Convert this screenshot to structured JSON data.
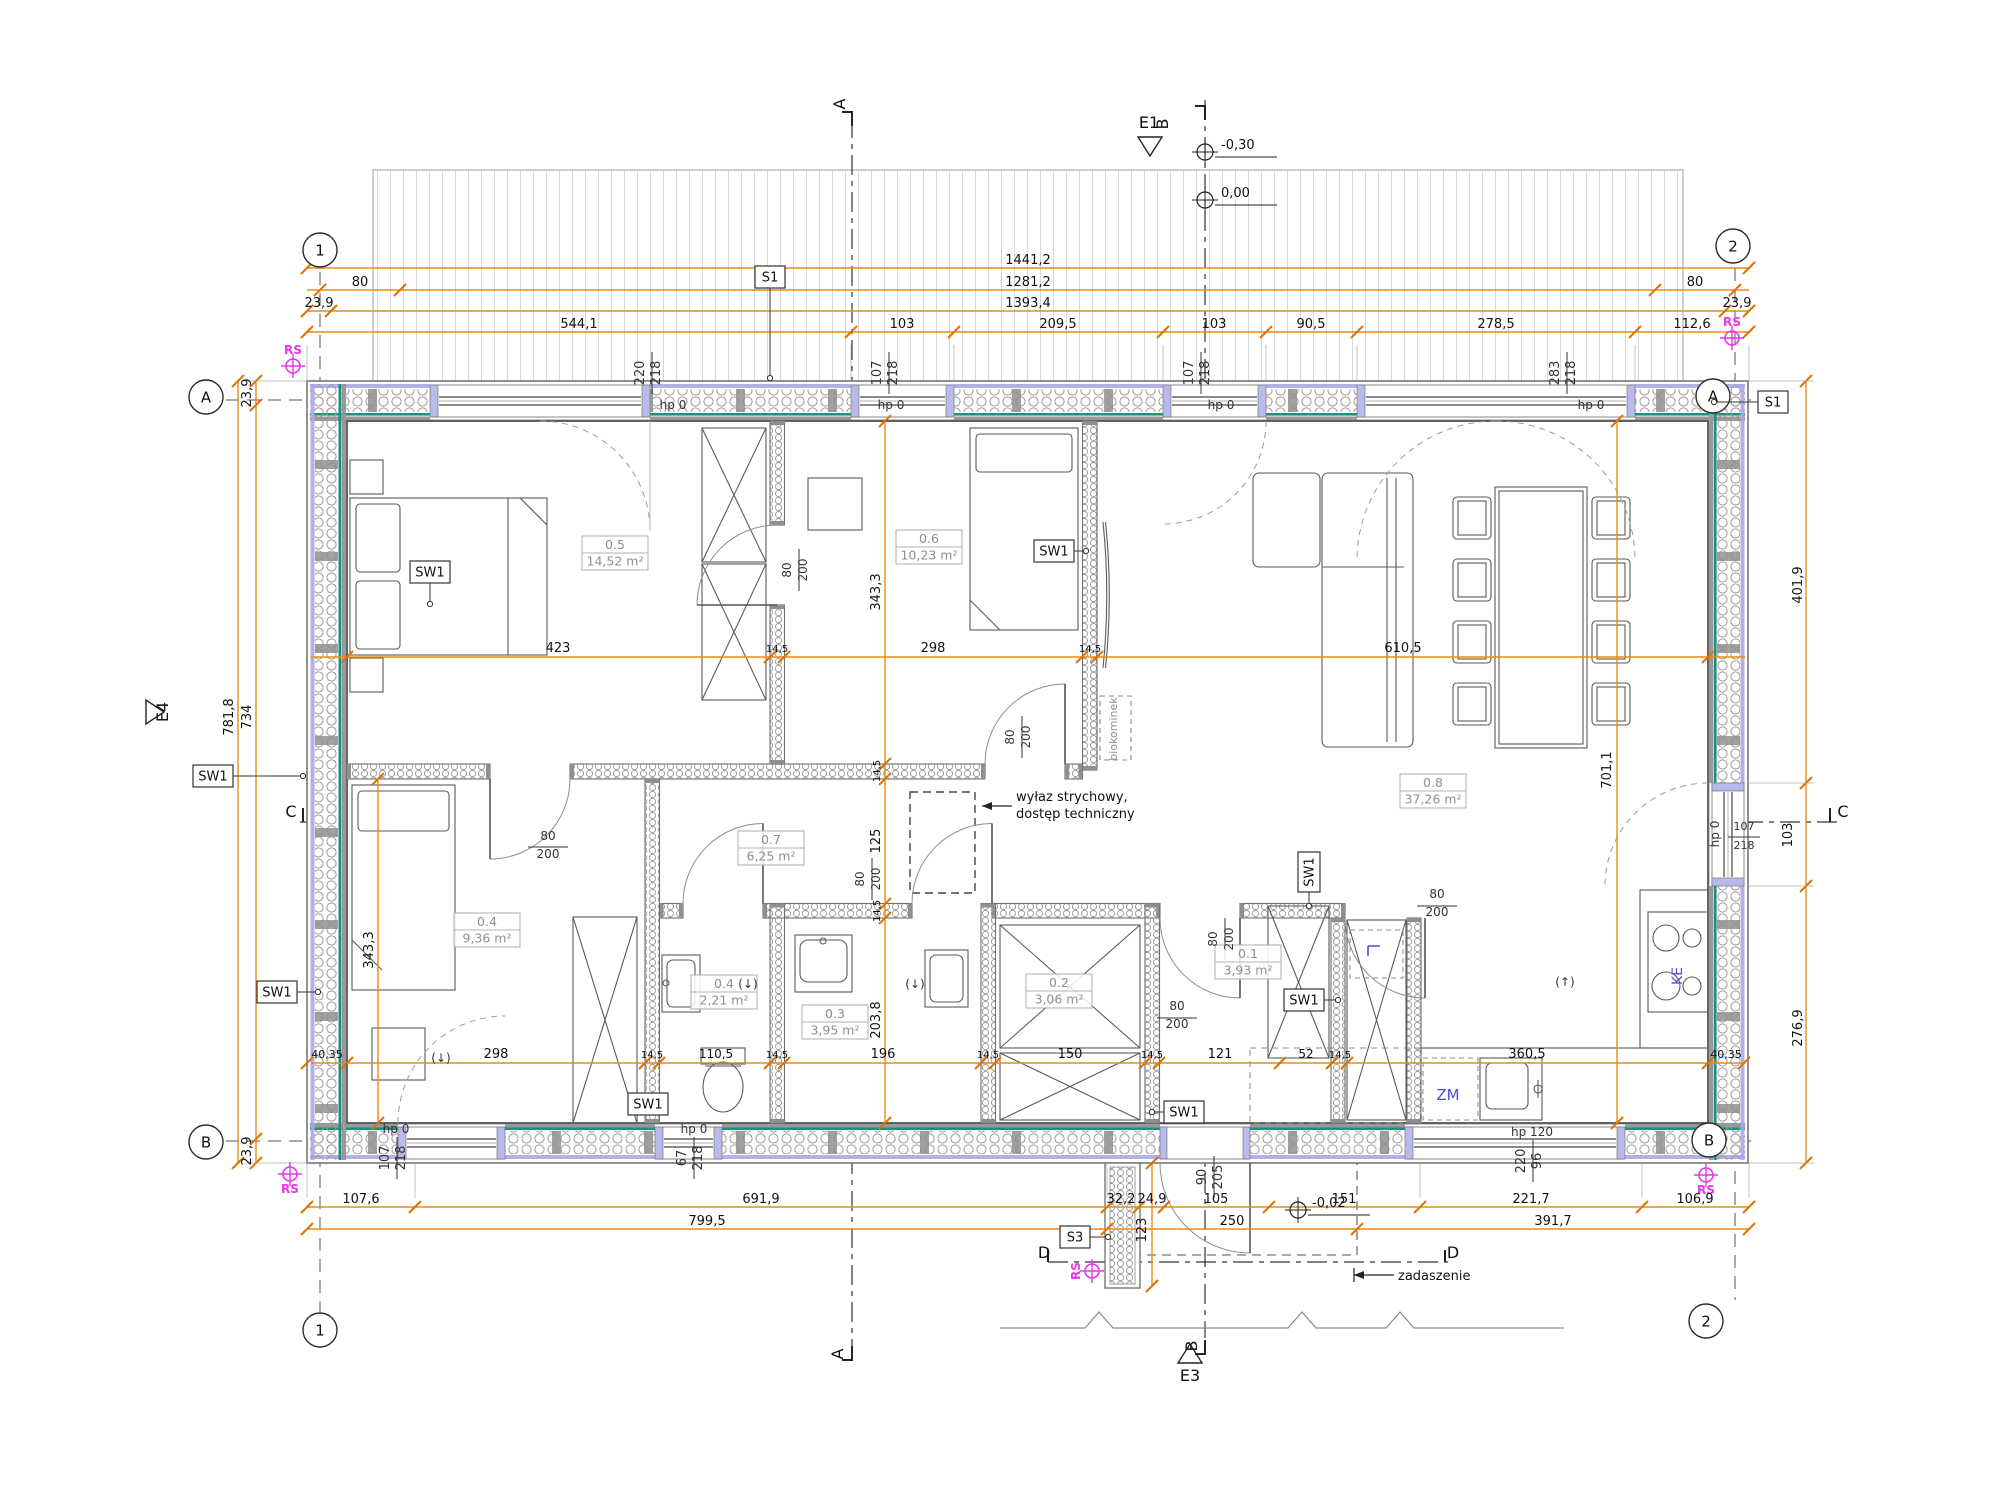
{
  "colors": {
    "dimension_orange": "#ee8a15",
    "tick_orange": "#dd7300",
    "survey_magenta": "#e836e8",
    "equipment_blue": "#4f4fd8",
    "wall_teal": "#1d8f7f",
    "wall_lilac": "#a9a9e6",
    "room_label_gray": "#8f8f8f",
    "line_dark": "#1a1a1a"
  },
  "grid_axes": [
    {
      "t": "1",
      "x": 320,
      "y": 250
    },
    {
      "t": "2",
      "x": 1733,
      "y": 246
    },
    {
      "t": "1",
      "x": 320,
      "y": 1330
    },
    {
      "t": "2",
      "x": 1706,
      "y": 1321
    },
    {
      "t": "A",
      "x": 206,
      "y": 397
    },
    {
      "t": "A",
      "x": 1713,
      "y": 396
    },
    {
      "t": "B",
      "x": 206,
      "y": 1142
    },
    {
      "t": "B",
      "x": 1709,
      "y": 1140
    }
  ],
  "sections": [
    {
      "t": "A",
      "x": 845,
      "y": 104,
      "r": -90
    },
    {
      "t": "A",
      "x": 843,
      "y": 1354,
      "r": -90
    },
    {
      "t": "B",
      "x": 1168,
      "y": 124,
      "r": -90
    },
    {
      "t": "B",
      "x": 1197,
      "y": 1346,
      "r": -90
    },
    {
      "t": "C",
      "x": 291,
      "y": 817
    },
    {
      "t": "C",
      "x": 1843,
      "y": 817
    },
    {
      "t": "D",
      "x": 1044,
      "y": 1258
    },
    {
      "t": "D",
      "x": 1453,
      "y": 1258
    },
    {
      "t": "E1",
      "x": 1149,
      "y": 128
    },
    {
      "t": "E3",
      "x": 1190,
      "y": 1381
    },
    {
      "t": "E4",
      "x": 168,
      "y": 712,
      "r": -90
    }
  ],
  "levels": [
    {
      "t": "-0,30",
      "x": 1205,
      "y": 152,
      "tx": 1221,
      "ty": 149
    },
    {
      "t": "0,00",
      "x": 1205,
      "y": 200,
      "tx": 1221,
      "ty": 197
    },
    {
      "t": "-0,02",
      "x": 1298,
      "y": 1210,
      "tx": 1312,
      "ty": 1207
    }
  ],
  "survey_points": [
    {
      "t": "RS",
      "x": 293,
      "y": 366,
      "tx": 293,
      "ty": 354
    },
    {
      "t": "RS",
      "x": 1732,
      "y": 338,
      "tx": 1732,
      "ty": 326
    },
    {
      "t": "RS",
      "x": 290,
      "y": 1174,
      "tx": 290,
      "ty": 1193
    },
    {
      "t": "RS",
      "x": 1706,
      "y": 1175,
      "tx": 1706,
      "ty": 1194
    },
    {
      "t": "RS",
      "x": 1092,
      "y": 1271,
      "tx": 1080,
      "ty": 1271,
      "r": -90
    }
  ],
  "rooms": [
    {
      "id": "0.5",
      "area": "14,52 m²",
      "x": 615,
      "y": 553
    },
    {
      "id": "0.6",
      "area": "10,23 m²",
      "x": 929,
      "y": 547
    },
    {
      "id": "0.8",
      "area": "37,26 m²",
      "x": 1433,
      "y": 791
    },
    {
      "id": "0.7",
      "area": "6,25 m²",
      "x": 771,
      "y": 848
    },
    {
      "id": "0.4",
      "area": "9,36 m²",
      "x": 487,
      "y": 930
    },
    {
      "id": "0.4",
      "area": "2,21 m²",
      "x": 724,
      "y": 992
    },
    {
      "id": "0.3",
      "area": "3,95 m²",
      "x": 835,
      "y": 1022
    },
    {
      "id": "0.2",
      "area": "3,06 m²",
      "x": 1059,
      "y": 991
    },
    {
      "id": "0.1",
      "area": "3,93 m²",
      "x": 1248,
      "y": 962
    }
  ],
  "component_tags": [
    {
      "t": "SW1",
      "x": 213,
      "y": 776,
      "lx": 303,
      "ly": 776
    },
    {
      "t": "SW1",
      "x": 277,
      "y": 992,
      "lx": 318,
      "ly": 992
    },
    {
      "t": "SW1",
      "x": 430,
      "y": 572,
      "lx": 430,
      "ly": 604
    },
    {
      "t": "SW1",
      "x": 1054,
      "y": 551,
      "lx": 1086,
      "ly": 551
    },
    {
      "t": "SW1",
      "x": 648,
      "y": 1104,
      "lx": 634,
      "ly": 1104
    },
    {
      "t": "SW1",
      "x": 1184,
      "y": 1112,
      "lx": 1152,
      "ly": 1112
    },
    {
      "t": "SW1",
      "x": 1309,
      "y": 872,
      "lx": 1309,
      "ly": 906,
      "r": -90
    },
    {
      "t": "SW1",
      "x": 1304,
      "y": 1000,
      "lx": 1338,
      "ly": 1000
    },
    {
      "t": "S1",
      "x": 770,
      "y": 277,
      "lx": 770,
      "ly": 378
    },
    {
      "t": "S1",
      "x": 1773,
      "y": 402,
      "lx": 1714,
      "ly": 402
    },
    {
      "t": "S3",
      "x": 1075,
      "y": 1237,
      "lx": 1108,
      "ly": 1237
    }
  ],
  "dimensions": [
    {
      "t": "1441,2",
      "x": 1028,
      "y": 264
    },
    {
      "t": "80",
      "x": 360,
      "y": 286
    },
    {
      "t": "1281,2",
      "x": 1028,
      "y": 286
    },
    {
      "t": "80",
      "x": 1695,
      "y": 286
    },
    {
      "t": "23,9",
      "x": 319,
      "y": 307
    },
    {
      "t": "1393,4",
      "x": 1028,
      "y": 307
    },
    {
      "t": "23,9",
      "x": 1737,
      "y": 307
    },
    {
      "t": "544,1",
      "x": 579,
      "y": 328
    },
    {
      "t": "103",
      "x": 902,
      "y": 328
    },
    {
      "t": "209,5",
      "x": 1058,
      "y": 328
    },
    {
      "t": "103",
      "x": 1214,
      "y": 328
    },
    {
      "t": "90,5",
      "x": 1311,
      "y": 328
    },
    {
      "t": "278,5",
      "x": 1496,
      "y": 328
    },
    {
      "t": "112,6",
      "x": 1692,
      "y": 328
    },
    {
      "t": "107,6",
      "x": 361,
      "y": 1203
    },
    {
      "t": "691,9",
      "x": 761,
      "y": 1203
    },
    {
      "t": "32,2",
      "x": 1121,
      "y": 1203
    },
    {
      "t": "24,9",
      "x": 1152,
      "y": 1203
    },
    {
      "t": "105",
      "x": 1216,
      "y": 1203
    },
    {
      "t": "151",
      "x": 1344,
      "y": 1203
    },
    {
      "t": "221,7",
      "x": 1531,
      "y": 1203
    },
    {
      "t": "106,9",
      "x": 1695,
      "y": 1203
    },
    {
      "t": "799,5",
      "x": 707,
      "y": 1225
    },
    {
      "t": "250",
      "x": 1232,
      "y": 1225
    },
    {
      "t": "391,7",
      "x": 1553,
      "y": 1225
    },
    {
      "t": "781,8",
      "x": 233,
      "y": 717,
      "r": -90
    },
    {
      "t": "734",
      "x": 251,
      "y": 717,
      "r": -90
    },
    {
      "t": "23,9",
      "x": 251,
      "y": 393,
      "r": -90
    },
    {
      "t": "23,9",
      "x": 251,
      "y": 1151,
      "r": -90
    },
    {
      "t": "401,9",
      "x": 1802,
      "y": 585,
      "r": -90
    },
    {
      "t": "103",
      "x": 1792,
      "y": 835,
      "r": -90
    },
    {
      "t": "276,9",
      "x": 1802,
      "y": 1028,
      "r": -90
    },
    {
      "t": "423",
      "x": 558,
      "y": 652
    },
    {
      "t": "14,5",
      "x": 777,
      "y": 652,
      "s": 10
    },
    {
      "t": "298",
      "x": 933,
      "y": 652
    },
    {
      "t": "14,5",
      "x": 1090,
      "y": 652,
      "s": 10
    },
    {
      "t": "610,5",
      "x": 1403,
      "y": 652
    },
    {
      "t": "40,35",
      "x": 327,
      "y": 1058,
      "s": 11
    },
    {
      "t": "298",
      "x": 496,
      "y": 1058
    },
    {
      "t": "14,5",
      "x": 652,
      "y": 1058,
      "s": 10
    },
    {
      "t": "110,5",
      "x": 716,
      "y": 1058,
      "s": 12
    },
    {
      "t": "14,5",
      "x": 777,
      "y": 1058,
      "s": 10
    },
    {
      "t": "196",
      "x": 883,
      "y": 1058
    },
    {
      "t": "14,5",
      "x": 988,
      "y": 1058,
      "s": 10
    },
    {
      "t": "150",
      "x": 1070,
      "y": 1058
    },
    {
      "t": "14,5",
      "x": 1152,
      "y": 1058,
      "s": 10
    },
    {
      "t": "121",
      "x": 1220,
      "y": 1058
    },
    {
      "t": "52",
      "x": 1306,
      "y": 1058,
      "s": 12
    },
    {
      "t": "14,5",
      "x": 1340,
      "y": 1058,
      "s": 10
    },
    {
      "t": "360,5",
      "x": 1527,
      "y": 1058
    },
    {
      "t": "40,35",
      "x": 1726,
      "y": 1058,
      "s": 11
    },
    {
      "t": "343,3",
      "x": 373,
      "y": 950,
      "r": -90
    },
    {
      "t": "343,3",
      "x": 880,
      "y": 592,
      "r": -90
    },
    {
      "t": "14,5",
      "x": 880,
      "y": 771,
      "r": -90,
      "s": 10
    },
    {
      "t": "125",
      "x": 880,
      "y": 841,
      "r": -90
    },
    {
      "t": "14,5",
      "x": 880,
      "y": 911,
      "r": -90,
      "s": 10
    },
    {
      "t": "203,8",
      "x": 880,
      "y": 1020,
      "r": -90
    },
    {
      "t": "701,1",
      "x": 1611,
      "y": 770,
      "r": -90
    },
    {
      "t": "123",
      "x": 1146,
      "y": 1230,
      "r": -90
    }
  ],
  "openings": [
    {
      "t": "220",
      "x": 644,
      "y": 373,
      "r": -90
    },
    {
      "t": "218",
      "x": 660,
      "y": 373,
      "r": -90
    },
    {
      "t": "hp 0",
      "x": 673,
      "y": 409,
      "s": 12
    },
    {
      "t": "107",
      "x": 881,
      "y": 373,
      "r": -90
    },
    {
      "t": "218",
      "x": 897,
      "y": 373,
      "r": -90
    },
    {
      "t": "hp 0",
      "x": 891,
      "y": 409,
      "s": 12
    },
    {
      "t": "107",
      "x": 1193,
      "y": 373,
      "r": -90
    },
    {
      "t": "218",
      "x": 1209,
      "y": 373,
      "r": -90
    },
    {
      "t": "hp 0",
      "x": 1221,
      "y": 409,
      "s": 12
    },
    {
      "t": "283",
      "x": 1559,
      "y": 373,
      "r": -90
    },
    {
      "t": "218",
      "x": 1575,
      "y": 373,
      "r": -90
    },
    {
      "t": "hp 0",
      "x": 1591,
      "y": 409,
      "s": 12
    },
    {
      "t": "hp 0",
      "x": 1719,
      "y": 834,
      "r": -90,
      "s": 12
    },
    {
      "t": "107",
      "x": 1744,
      "y": 830,
      "s": 11
    },
    {
      "t": "218",
      "x": 1744,
      "y": 849,
      "s": 11
    },
    {
      "t": "hp 0",
      "x": 396,
      "y": 1133,
      "s": 12
    },
    {
      "t": "107",
      "x": 389,
      "y": 1158,
      "r": -90
    },
    {
      "t": "218",
      "x": 405,
      "y": 1158,
      "r": -90
    },
    {
      "t": "hp 0",
      "x": 694,
      "y": 1133,
      "s": 12
    },
    {
      "t": "67",
      "x": 686,
      "y": 1158,
      "r": -90
    },
    {
      "t": "218",
      "x": 702,
      "y": 1158,
      "r": -90
    },
    {
      "t": "90",
      "x": 1206,
      "y": 1177,
      "r": -90
    },
    {
      "t": "205",
      "x": 1222,
      "y": 1177,
      "r": -90
    },
    {
      "t": "hp 120",
      "x": 1532,
      "y": 1136,
      "s": 12
    },
    {
      "t": "220",
      "x": 1525,
      "y": 1161,
      "r": -90
    },
    {
      "t": "96",
      "x": 1541,
      "y": 1161,
      "r": -90
    },
    {
      "t": "80",
      "x": 791,
      "y": 570,
      "r": -90,
      "s": 12
    },
    {
      "t": "200",
      "x": 807,
      "y": 570,
      "r": -90,
      "s": 12
    },
    {
      "t": "80",
      "x": 1014,
      "y": 737,
      "r": -90,
      "s": 12
    },
    {
      "t": "200",
      "x": 1030,
      "y": 737,
      "r": -90,
      "s": 12
    },
    {
      "t": "80",
      "x": 548,
      "y": 840,
      "s": 12
    },
    {
      "t": "200",
      "x": 548,
      "y": 858,
      "s": 12
    },
    {
      "t": "80",
      "x": 864,
      "y": 879,
      "r": -90,
      "s": 12
    },
    {
      "t": "200",
      "x": 880,
      "y": 879,
      "r": -90,
      "s": 12
    },
    {
      "t": "80",
      "x": 1217,
      "y": 939,
      "r": -90,
      "s": 12
    },
    {
      "t": "200",
      "x": 1233,
      "y": 939,
      "r": -90,
      "s": 12
    },
    {
      "t": "80",
      "x": 1177,
      "y": 1010,
      "s": 12
    },
    {
      "t": "200",
      "x": 1177,
      "y": 1028,
      "s": 12
    },
    {
      "t": "80",
      "x": 1437,
      "y": 898,
      "s": 12
    },
    {
      "t": "200",
      "x": 1437,
      "y": 916,
      "s": 12
    }
  ],
  "annotations": [
    {
      "t": "wyłaz strychowy,",
      "x": 1016,
      "y": 801,
      "a": "start"
    },
    {
      "t": "dostęp techniczny",
      "x": 1016,
      "y": 818,
      "a": "start"
    },
    {
      "t": "zadaszenie",
      "x": 1398,
      "y": 1280,
      "a": "start"
    },
    {
      "t": "biokominek",
      "x": 1117,
      "y": 729,
      "r": -90,
      "c": "gray",
      "s": 11
    }
  ],
  "equipment": [
    {
      "t": "ZM",
      "x": 1448,
      "y": 1100,
      "c": "blue",
      "s": 15
    },
    {
      "t": "KE",
      "x": 1682,
      "y": 976,
      "c": "blue",
      "s": 14,
      "r": -90
    },
    {
      "t": "(↓)",
      "x": 748,
      "y": 988,
      "s": 12
    },
    {
      "t": "(↓)",
      "x": 915,
      "y": 988,
      "s": 12
    },
    {
      "t": "(↓)",
      "x": 441,
      "y": 1062,
      "s": 12
    },
    {
      "t": "(↑)",
      "x": 1565,
      "y": 986,
      "s": 12
    }
  ]
}
